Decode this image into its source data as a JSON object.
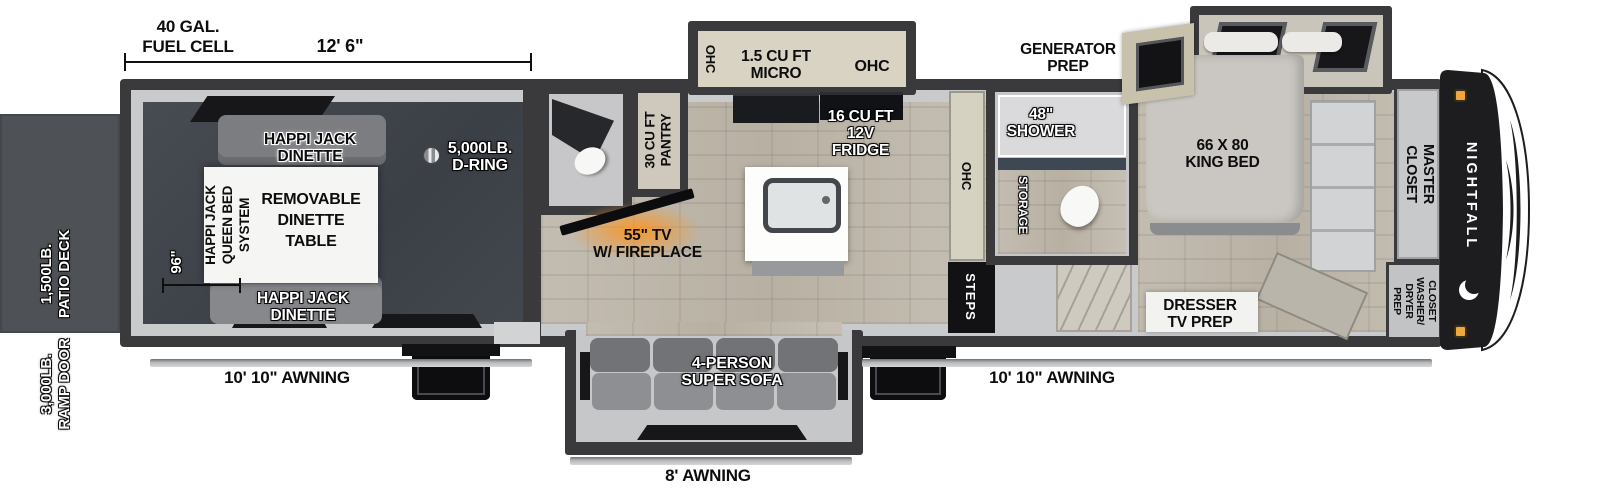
{
  "title": "Nightfall Toy Hauler Floorplan",
  "brand": "NIGHTFALL",
  "measurements": {
    "fuel_cell": "40 GAL.\nFUEL CELL",
    "garage_length": "12' 6\"",
    "garage_width": "96\"",
    "awning_left": "10' 10\" AWNING",
    "awning_right": "10' 10\" AWNING",
    "awning_rear": "8' AWNING"
  },
  "exterior": {
    "patio_deck": "1,500LB.\nPATIO DECK",
    "ramp_door": "3,000LB.\nRAMP DOOR",
    "generator_prep": "GENERATOR\nPREP"
  },
  "garage": {
    "dinette_front": "HAPPI JACK\nDINETTE",
    "dinette_rear": "HAPPI JACK\nDINETTE",
    "queen_bed_system": "HAPPI JACK\nQUEEN BED\nSYSTEM",
    "removable_table": "REMOVABLE\nDINETTE\nTABLE",
    "d_ring": "5,000LB.\nD-RING"
  },
  "kitchen": {
    "pantry": "30 CU FT\nPANTRY",
    "ohc_slide_left": "OHC",
    "microwave": "1.5 CU FT\nMICRO",
    "ohc_slide_right": "OHC",
    "fridge": "16 CU FT\n12V\nFRIDGE",
    "ohc_wall": "OHC"
  },
  "living": {
    "tv_fireplace": "55\" TV\nW/ FIREPLACE",
    "sofa": "4-PERSON\nSUPER SOFA",
    "steps": "STEPS"
  },
  "bathroom": {
    "shower": "48\"\nSHOWER",
    "storage": "STORAGE"
  },
  "bedroom": {
    "king_bed": "66 X 80\nKING BED",
    "dresser": "DRESSER\nTV PREP",
    "master_closet": "MASTER\nCLOSET",
    "washer_dryer_prep": "CLOSET\nWASHER/\nDRYER\nPREP"
  },
  "colors": {
    "wall": "#3a3a3c",
    "interior": "#c9cacc",
    "garage_floor": "#41454c",
    "wood_floor": "#bdb6aa",
    "deck": "#4e5257",
    "cabinet": "#d8d3c3",
    "accent_glow": "#f09a2e",
    "front_cap": "#1d1d1f",
    "marker_light": "#f0a73f"
  }
}
